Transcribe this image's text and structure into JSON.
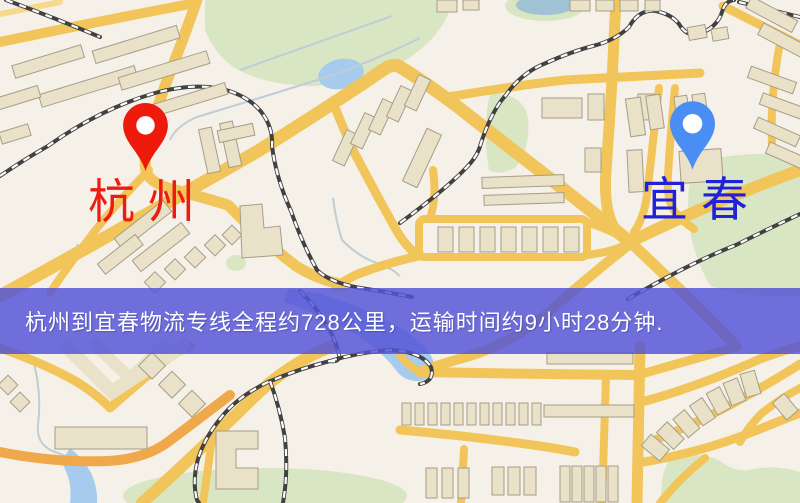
{
  "origin": {
    "label": "杭州",
    "icon": "red-location-pin",
    "marker_color": "#ee1b0c",
    "label_color": "#ed1c12"
  },
  "destination": {
    "label": "宜春",
    "icon": "blue-location-pin",
    "marker_color": "#4a8ef5",
    "label_color": "#2121d8"
  },
  "banner": {
    "text": "杭州到宜春物流专线全程约728公里，运输时间约9小时28分钟.",
    "background": "#5555d6",
    "text_color": "#ffffff"
  },
  "route": {
    "origin_city": "杭州",
    "destination_city": "宜春",
    "distance_text": "约728公里",
    "duration_text": "约9小时28分钟"
  },
  "map_colors": {
    "background": "#f6f1e8",
    "road": "#f2c55b",
    "water": "#a6cbed",
    "park": "#d9e6c4",
    "building": "#e9e1c8",
    "railway": "#414141"
  }
}
